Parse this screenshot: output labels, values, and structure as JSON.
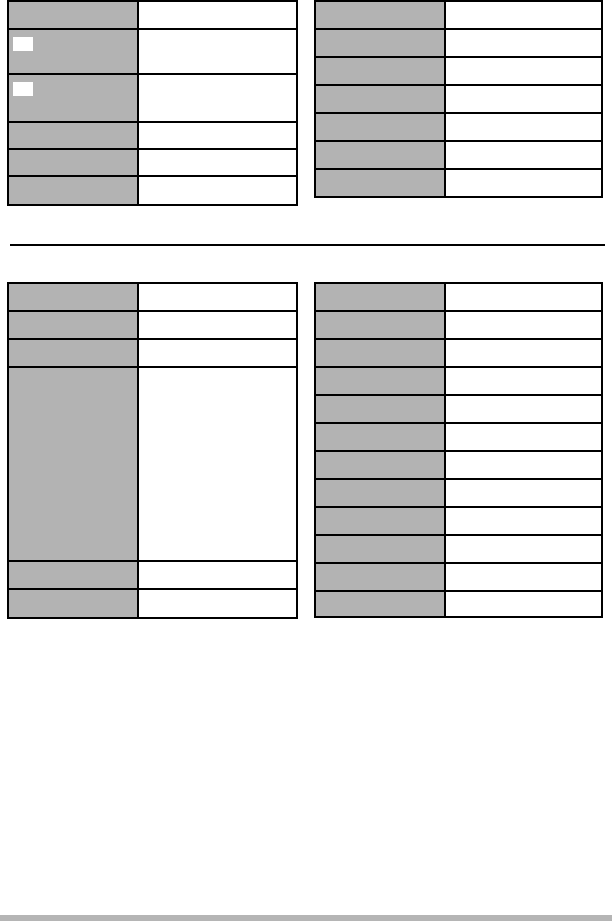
{
  "document": {
    "description": "Blank two-column specification tables page; all cells are empty (no visible text)",
    "text_content_visible": false
  },
  "colors": {
    "page_background": "#ffffff",
    "table_border": "#000000",
    "header_cell_fill": "#b3b3b3",
    "value_cell_fill": "#ffffff",
    "image_placeholder_fill": "#ffffff",
    "divider_rule": "#000000",
    "footer_bar": "#b5b5b5"
  },
  "divider_rule": {
    "present": true
  },
  "footer_bar": {
    "present": true
  },
  "tables": [
    {
      "name": "top-left-table",
      "position": "top-left",
      "columns": 2,
      "rows": [
        {
          "label": "",
          "value": "",
          "height": 28,
          "icon_placeholder": false
        },
        {
          "label": "",
          "value": "",
          "height": 45,
          "icon_placeholder": true
        },
        {
          "label": "",
          "value": "",
          "height": 48,
          "icon_placeholder": true
        },
        {
          "label": "",
          "value": "",
          "height": 27,
          "icon_placeholder": false
        },
        {
          "label": "",
          "value": "",
          "height": 27,
          "icon_placeholder": false
        },
        {
          "label": "",
          "value": "",
          "height": 27,
          "icon_placeholder": false
        }
      ]
    },
    {
      "name": "top-right-table",
      "position": "top-right",
      "columns": 2,
      "rows": [
        {
          "label": "",
          "value": "",
          "height": 28,
          "icon_placeholder": false
        },
        {
          "label": "",
          "value": "",
          "height": 28,
          "icon_placeholder": false
        },
        {
          "label": "",
          "value": "",
          "height": 28,
          "icon_placeholder": false
        },
        {
          "label": "",
          "value": "",
          "height": 28,
          "icon_placeholder": false
        },
        {
          "label": "",
          "value": "",
          "height": 28,
          "icon_placeholder": false
        },
        {
          "label": "",
          "value": "",
          "height": 28,
          "icon_placeholder": false
        },
        {
          "label": "",
          "value": "",
          "height": 26,
          "icon_placeholder": false
        }
      ]
    },
    {
      "name": "bottom-left-table",
      "position": "bottom-left",
      "columns": 2,
      "rows": [
        {
          "label": "",
          "value": "",
          "height": 28,
          "icon_placeholder": false
        },
        {
          "label": "",
          "value": "",
          "height": 28,
          "icon_placeholder": false
        },
        {
          "label": "",
          "value": "",
          "height": 28,
          "icon_placeholder": false
        },
        {
          "label": "",
          "value": "",
          "height": 194,
          "icon_placeholder": false
        },
        {
          "label": "",
          "value": "",
          "height": 28,
          "icon_placeholder": false
        },
        {
          "label": "",
          "value": "",
          "height": 27,
          "icon_placeholder": false
        }
      ]
    },
    {
      "name": "bottom-right-table",
      "position": "bottom-right",
      "columns": 2,
      "rows": [
        {
          "label": "",
          "value": "",
          "height": 28,
          "icon_placeholder": false
        },
        {
          "label": "",
          "value": "",
          "height": 28,
          "icon_placeholder": false
        },
        {
          "label": "",
          "value": "",
          "height": 28,
          "icon_placeholder": false
        },
        {
          "label": "",
          "value": "",
          "height": 28,
          "icon_placeholder": false
        },
        {
          "label": "",
          "value": "",
          "height": 28,
          "icon_placeholder": false
        },
        {
          "label": "",
          "value": "",
          "height": 28,
          "icon_placeholder": false
        },
        {
          "label": "",
          "value": "",
          "height": 28,
          "icon_placeholder": false
        },
        {
          "label": "",
          "value": "",
          "height": 28,
          "icon_placeholder": false
        },
        {
          "label": "",
          "value": "",
          "height": 28,
          "icon_placeholder": false
        },
        {
          "label": "",
          "value": "",
          "height": 28,
          "icon_placeholder": false
        },
        {
          "label": "",
          "value": "",
          "height": 28,
          "icon_placeholder": false
        },
        {
          "label": "",
          "value": "",
          "height": 24,
          "icon_placeholder": false
        }
      ]
    }
  ]
}
